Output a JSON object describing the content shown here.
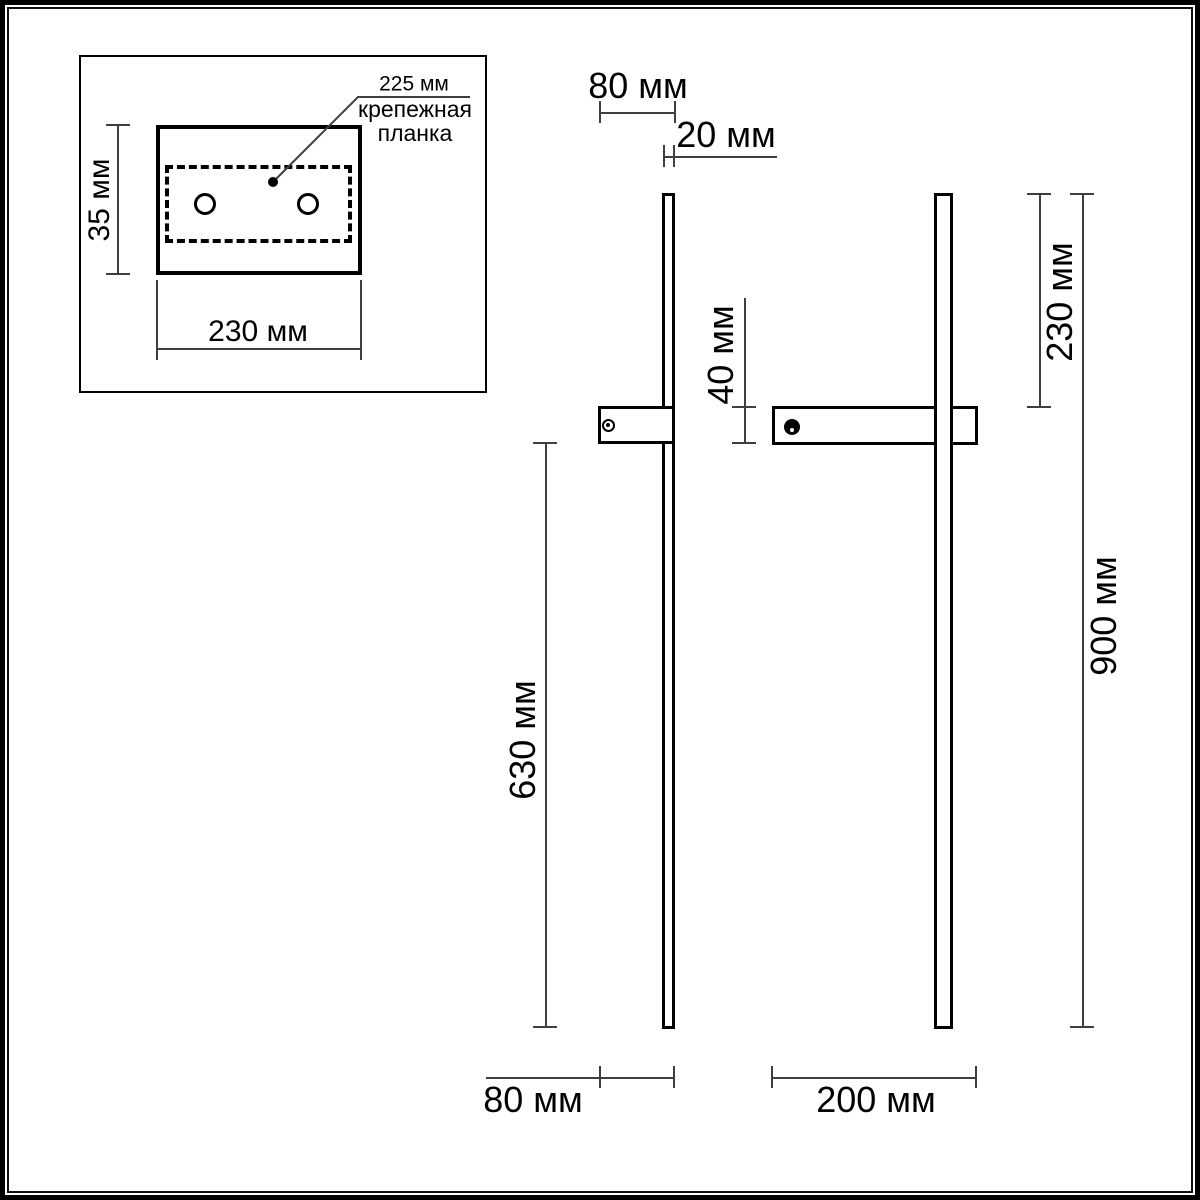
{
  "inset": {
    "hole_spacing": "225 мм",
    "plate_name_line1": "крепежная",
    "plate_name_line2": "планка",
    "plate_height": "35 мм",
    "plate_width": "230 мм"
  },
  "side_view": {
    "depth_top": "80 мм",
    "thickness": "20 мм",
    "bracket_height": "40 мм",
    "lower_length": "630 мм",
    "depth_bottom": "80 мм"
  },
  "front_view": {
    "top_offset": "230 мм",
    "total_height": "900 мм",
    "bracket_width": "200 мм"
  },
  "colors": {
    "outline": "#000000",
    "dimension_line": "#3f3f3f",
    "background": "#ffffff"
  }
}
